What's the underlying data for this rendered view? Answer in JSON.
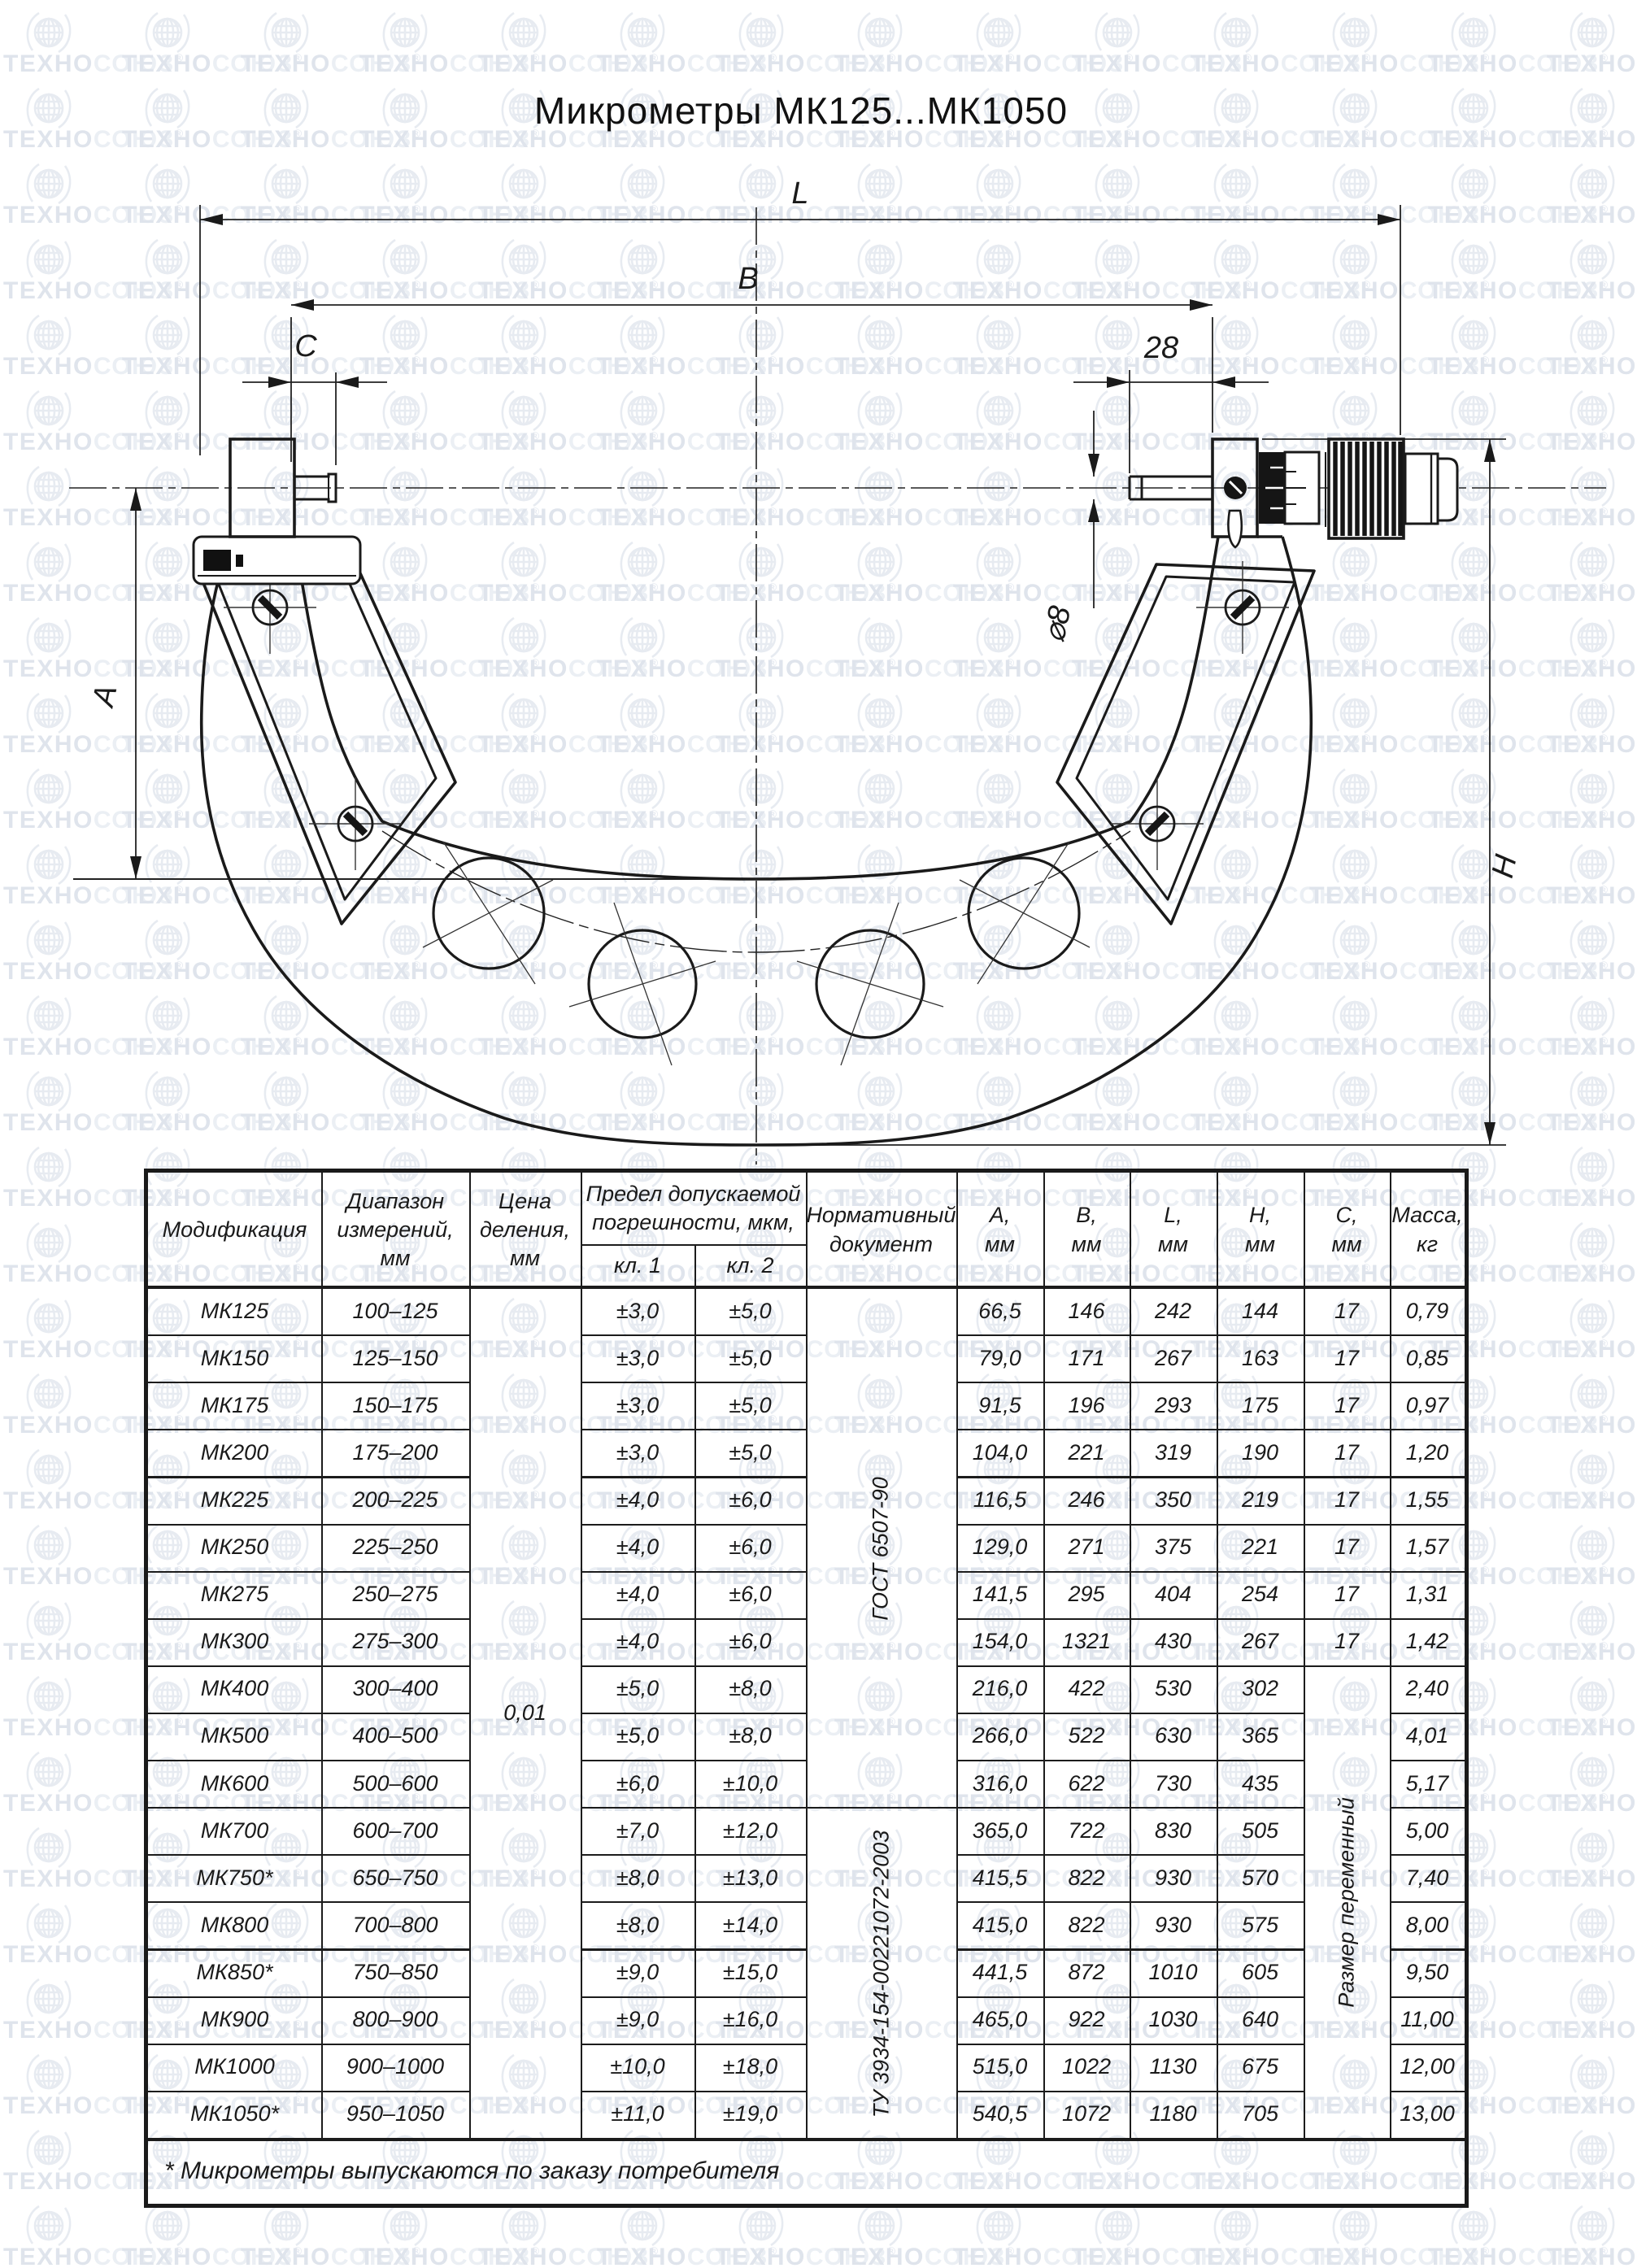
{
  "page": {
    "title": "Микрометры МК125...МК1050",
    "watermark_prefix": "ТЕХНО",
    "watermark_suffix": "СОЮЗ",
    "watermark_reg": "®",
    "footnote": "* Микрометры выпускаются по заказу потребителя"
  },
  "drawing": {
    "labels": {
      "L": "L",
      "B": "B",
      "C": "C",
      "len28": "28",
      "dia8": "⌀8",
      "A": "A",
      "H": "H"
    }
  },
  "table": {
    "headers": {
      "modification": "Модификация",
      "range": "Диапазон\nизмерений,\nмм",
      "division": "Цена\nделения,\nмм",
      "error_limit": "Предел допускаемой\nпогрешности, мкм,",
      "class1": "кл. 1",
      "class2": "кл. 2",
      "document": "Нормативный\nдокумент",
      "col_a": "А,\nмм",
      "col_b": "В,\nмм",
      "col_l": "L,\nмм",
      "col_h": "Н,\nмм",
      "col_c": "С,\nмм",
      "mass": "Масса,\nкг"
    },
    "merged": {
      "division_value": "0,01",
      "doc1": "ГОСТ 6507-90",
      "doc2": "ТУ 3934-154-00221072-2003",
      "c_variable": "Размер переменный"
    },
    "rows": [
      {
        "mod": "МК125",
        "range": "100–125",
        "kl1": "±3,0",
        "kl2": "±5,0",
        "a": "66,5",
        "b": "146",
        "l": "242",
        "h": "144",
        "c": "17",
        "mass": "0,79"
      },
      {
        "mod": "МК150",
        "range": "125–150",
        "kl1": "±3,0",
        "kl2": "±5,0",
        "a": "79,0",
        "b": "171",
        "l": "267",
        "h": "163",
        "c": "17",
        "mass": "0,85"
      },
      {
        "mod": "МК175",
        "range": "150–175",
        "kl1": "±3,0",
        "kl2": "±5,0",
        "a": "91,5",
        "b": "196",
        "l": "293",
        "h": "175",
        "c": "17",
        "mass": "0,97"
      },
      {
        "mod": "МК200",
        "range": "175–200",
        "kl1": "±3,0",
        "kl2": "±5,0",
        "a": "104,0",
        "b": "221",
        "l": "319",
        "h": "190",
        "c": "17",
        "mass": "1,20"
      },
      {
        "mod": "МК225",
        "range": "200–225",
        "kl1": "±4,0",
        "kl2": "±6,0",
        "a": "116,5",
        "b": "246",
        "l": "350",
        "h": "219",
        "c": "17",
        "mass": "1,55"
      },
      {
        "mod": "МК250",
        "range": "225–250",
        "kl1": "±4,0",
        "kl2": "±6,0",
        "a": "129,0",
        "b": "271",
        "l": "375",
        "h": "221",
        "c": "17",
        "mass": "1,57"
      },
      {
        "mod": "МК275",
        "range": "250–275",
        "kl1": "±4,0",
        "kl2": "±6,0",
        "a": "141,5",
        "b": "295",
        "l": "404",
        "h": "254",
        "c": "17",
        "mass": "1,31"
      },
      {
        "mod": "МК300",
        "range": "275–300",
        "kl1": "±4,0",
        "kl2": "±6,0",
        "a": "154,0",
        "b": "1321",
        "l": "430",
        "h": "267",
        "c": "17",
        "mass": "1,42"
      },
      {
        "mod": "МК400",
        "range": "300–400",
        "kl1": "±5,0",
        "kl2": "±8,0",
        "a": "216,0",
        "b": "422",
        "l": "530",
        "h": "302",
        "mass": "2,40"
      },
      {
        "mod": "МК500",
        "range": "400–500",
        "kl1": "±5,0",
        "kl2": "±8,0",
        "a": "266,0",
        "b": "522",
        "l": "630",
        "h": "365",
        "mass": "4,01"
      },
      {
        "mod": "МК600",
        "range": "500–600",
        "kl1": "±6,0",
        "kl2": "±10,0",
        "a": "316,0",
        "b": "622",
        "l": "730",
        "h": "435",
        "mass": "5,17"
      },
      {
        "mod": "МК700",
        "range": "600–700",
        "kl1": "±7,0",
        "kl2": "±12,0",
        "a": "365,0",
        "b": "722",
        "l": "830",
        "h": "505",
        "mass": "5,00"
      },
      {
        "mod": "МК750*",
        "range": "650–750",
        "kl1": "±8,0",
        "kl2": "±13,0",
        "a": "415,5",
        "b": "822",
        "l": "930",
        "h": "570",
        "mass": "7,40"
      },
      {
        "mod": "МК800",
        "range": "700–800",
        "kl1": "±8,0",
        "kl2": "±14,0",
        "a": "415,0",
        "b": "822",
        "l": "930",
        "h": "575",
        "mass": "8,00"
      },
      {
        "mod": "МК850*",
        "range": "750–850",
        "kl1": "±9,0",
        "kl2": "±15,0",
        "a": "441,5",
        "b": "872",
        "l": "1010",
        "h": "605",
        "mass": "9,50"
      },
      {
        "mod": "МК900",
        "range": "800–900",
        "kl1": "±9,0",
        "kl2": "±16,0",
        "a": "465,0",
        "b": "922",
        "l": "1030",
        "h": "640",
        "mass": "11,00"
      },
      {
        "mod": "МК1000",
        "range": "900–1000",
        "kl1": "±10,0",
        "kl2": "±18,0",
        "a": "515,0",
        "b": "1022",
        "l": "1130",
        "h": "675",
        "mass": "12,00"
      },
      {
        "mod": "МК1050*",
        "range": "950–1050",
        "kl1": "±11,0",
        "kl2": "±19,0",
        "a": "540,5",
        "b": "1072",
        "l": "1180",
        "h": "705",
        "mass": "13,00"
      }
    ]
  }
}
